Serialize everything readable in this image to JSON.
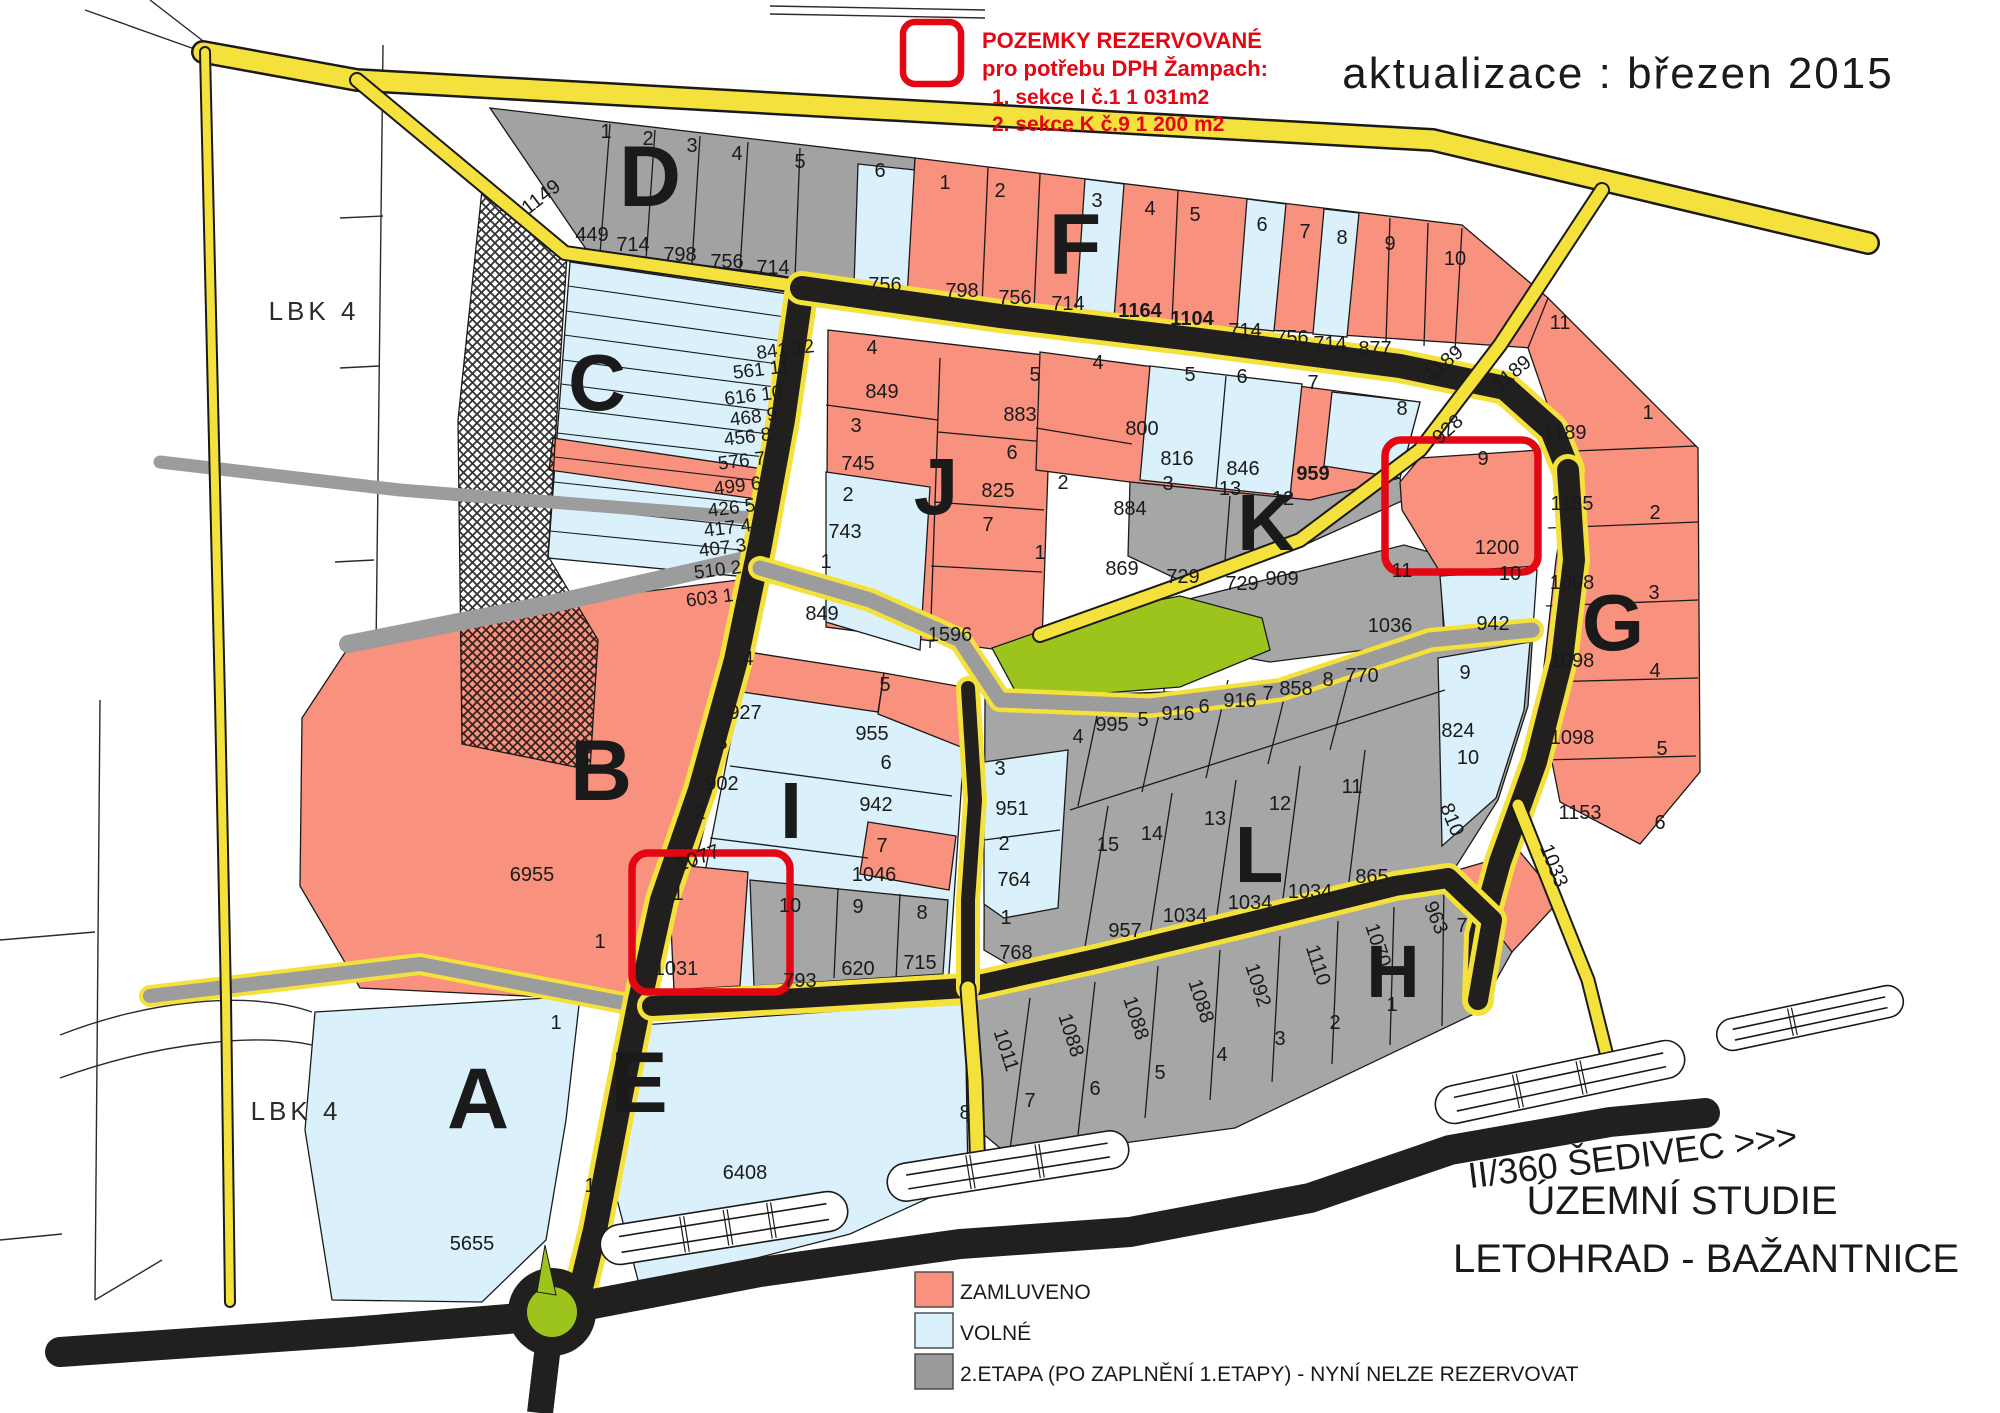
{
  "document": {
    "type": "zoning-plan-scan",
    "update_note": "aktualizace : březen 2015",
    "reserved_note": {
      "lines": [
        {
          "t": "POZEMKY REZERVOVANÉ",
          "x": 982,
          "y": 48
        },
        {
          "t": "pro potřebu DPH Žampach:",
          "x": 982,
          "y": 76
        },
        {
          "t": "1. sekce I  č.1   1 031m2",
          "x": 992,
          "y": 104
        },
        {
          "t": "2. sekce K č.9   1 200 m2",
          "x": 992,
          "y": 131
        }
      ],
      "color": "#e30613"
    },
    "titles": {
      "road": "II/360 ŠEDIVEC >>>",
      "study": "ÚZEMNÍ STUDIE",
      "place": "LETOHRAD - BAŽANTNICE"
    }
  },
  "legend": {
    "x": 915,
    "y0": 1272,
    "dy": 41,
    "items": [
      {
        "label": "ZAMLUVENO",
        "color": "#f9917f"
      },
      {
        "label": "VOLNÉ",
        "color": "#daf1fb"
      },
      {
        "label": "2.ETAPA (PO ZAPLNĚNÍ 1.ETAPY) - NYNÍ NELZE REZERVOVAT",
        "color": "#9a9a9a"
      }
    ]
  },
  "map_colors": {
    "reserved_outline": "#e30613",
    "booked_salmon": "#f9917f",
    "free_blue": "#daf1fb",
    "stage2_gray": "#a6a6a6",
    "road_yellow": "#f5e13b",
    "road_black": "#221f1f",
    "green": "#9dc41d"
  },
  "map": {
    "labels": [
      {
        "t": "POZEMKY REZERVOVANÉ",
        "x": 982,
        "y": 48,
        "s": 22,
        "w": 700,
        "c": "#e30613",
        "a": "start",
        "n": "reserved-note-line1"
      },
      {
        "t": "pro potřebu DPH Žampach:",
        "x": 982,
        "y": 76,
        "s": 22,
        "w": 700,
        "c": "#e30613",
        "a": "start",
        "n": "reserved-note-line2"
      },
      {
        "t": "1. sekce I  č.1   1 031m2",
        "x": 992,
        "y": 104,
        "s": 21,
        "w": 700,
        "c": "#e30613",
        "a": "start",
        "n": "reserved-note-line3"
      },
      {
        "t": "2. sekce K č.9   1 200 m2",
        "x": 992,
        "y": 131,
        "s": 21,
        "w": 700,
        "c": "#e30613",
        "a": "start",
        "n": "reserved-note-line4"
      },
      {
        "t": "aktualizace : březen 2015",
        "x": 1618,
        "y": 88,
        "s": 44,
        "ls": 2,
        "n": "update-note"
      },
      {
        "t": "II/360 ŠEDIVEC >>>",
        "x": 1634,
        "y": 1168,
        "s": 36,
        "f": "serif",
        "r": -7,
        "n": "road-title"
      },
      {
        "t": "ÚZEMNÍ STUDIE",
        "x": 1682,
        "y": 1214,
        "s": 40,
        "f": "serif",
        "n": "study-title"
      },
      {
        "t": "LETOHRAD - BAŽANTNICE",
        "x": 1706,
        "y": 1272,
        "s": 40,
        "f": "serif",
        "n": "place-title"
      },
      {
        "t": "LBK  4",
        "x": 314,
        "y": 320,
        "s": 26,
        "ls": 4,
        "c": "#2b2b2b",
        "n": "lbk-label-top"
      },
      {
        "t": "LBK  4",
        "x": 296,
        "y": 1120,
        "s": 26,
        "ls": 4,
        "c": "#2b2b2b",
        "n": "lbk-label-bottom"
      },
      {
        "t": "D",
        "x": 650,
        "y": 206,
        "s": 86,
        "w": 900,
        "n": "section-letter-d"
      },
      {
        "t": "F",
        "x": 1075,
        "y": 274,
        "s": 86,
        "w": 900,
        "n": "section-letter-f"
      },
      {
        "t": "C",
        "x": 597,
        "y": 410,
        "s": 80,
        "w": 900,
        "n": "section-letter-c"
      },
      {
        "t": "J",
        "x": 936,
        "y": 514,
        "s": 80,
        "w": 900,
        "n": "section-letter-j"
      },
      {
        "t": "K",
        "x": 1266,
        "y": 550,
        "s": 80,
        "w": 900,
        "n": "section-letter-k"
      },
      {
        "t": "G",
        "x": 1613,
        "y": 650,
        "s": 80,
        "w": 900,
        "n": "section-letter-g"
      },
      {
        "t": "B",
        "x": 601,
        "y": 800,
        "s": 86,
        "w": 900,
        "n": "section-letter-b"
      },
      {
        "t": "I",
        "x": 791,
        "y": 838,
        "s": 80,
        "w": 900,
        "n": "section-letter-i"
      },
      {
        "t": "L",
        "x": 1259,
        "y": 882,
        "s": 80,
        "w": 900,
        "n": "section-letter-l"
      },
      {
        "t": "H",
        "x": 1393,
        "y": 997,
        "s": 74,
        "w": 900,
        "n": "section-letter-h"
      },
      {
        "t": "A",
        "x": 478,
        "y": 1128,
        "s": 86,
        "w": 900,
        "n": "section-letter-a"
      },
      {
        "t": "E",
        "x": 639,
        "y": 1112,
        "s": 86,
        "w": 900,
        "n": "section-letter-e"
      },
      {
        "t": "1",
        "x": 606,
        "y": 138
      },
      {
        "t": "2",
        "x": 648,
        "y": 145
      },
      {
        "t": "3",
        "x": 692,
        "y": 152
      },
      {
        "t": "4",
        "x": 737,
        "y": 160
      },
      {
        "t": "5",
        "x": 800,
        "y": 168
      },
      {
        "t": "6",
        "x": 880,
        "y": 177
      },
      {
        "t": "1149",
        "x": 545,
        "y": 202,
        "r": -38
      },
      {
        "t": "449",
        "x": 592,
        "y": 241
      },
      {
        "t": "714",
        "x": 633,
        "y": 251
      },
      {
        "t": "798",
        "x": 680,
        "y": 261
      },
      {
        "t": "756",
        "x": 727,
        "y": 268
      },
      {
        "t": "714",
        "x": 773,
        "y": 274
      },
      {
        "t": "756",
        "x": 885,
        "y": 291
      },
      {
        "t": "1",
        "x": 945,
        "y": 189
      },
      {
        "t": "2",
        "x": 1000,
        "y": 197
      },
      {
        "t": "3",
        "x": 1097,
        "y": 207
      },
      {
        "t": "4",
        "x": 1150,
        "y": 215
      },
      {
        "t": "5",
        "x": 1195,
        "y": 221
      },
      {
        "t": "6",
        "x": 1262,
        "y": 231
      },
      {
        "t": "7",
        "x": 1305,
        "y": 238
      },
      {
        "t": "8",
        "x": 1342,
        "y": 244
      },
      {
        "t": "9",
        "x": 1390,
        "y": 250
      },
      {
        "t": "10",
        "x": 1455,
        "y": 265
      },
      {
        "t": "11",
        "x": 1560,
        "y": 329
      },
      {
        "t": "798",
        "x": 962,
        "y": 297
      },
      {
        "t": "756",
        "x": 1015,
        "y": 304
      },
      {
        "t": "714",
        "x": 1068,
        "y": 310
      },
      {
        "t": "1164",
        "x": 1140,
        "y": 317,
        "w": 700
      },
      {
        "t": "1104",
        "x": 1192,
        "y": 325,
        "w": 700
      },
      {
        "t": "714",
        "x": 1245,
        "y": 337
      },
      {
        "t": "756",
        "x": 1292,
        "y": 344
      },
      {
        "t": "714",
        "x": 1330,
        "y": 350
      },
      {
        "t": "877",
        "x": 1375,
        "y": 355
      },
      {
        "t": "1189",
        "x": 1448,
        "y": 368,
        "r": -40
      },
      {
        "t": "1189",
        "x": 1516,
        "y": 378,
        "r": -40
      },
      {
        "t": "928",
        "x": 1452,
        "y": 434,
        "r": -42
      },
      {
        "t": "841 12",
        "x": 815,
        "y": 352,
        "s": 19,
        "a": "end",
        "r": -7
      },
      {
        "t": "561 11",
        "x": 790,
        "y": 372,
        "s": 19,
        "a": "end",
        "r": -7
      },
      {
        "t": "616 10",
        "x": 783,
        "y": 398,
        "s": 19,
        "a": "end",
        "r": -7
      },
      {
        "t": "468  9",
        "x": 778,
        "y": 420,
        "s": 19,
        "a": "end",
        "r": -7
      },
      {
        "t": "456  8",
        "x": 772,
        "y": 440,
        "s": 19,
        "a": "end",
        "r": -7
      },
      {
        "t": "576  7",
        "x": 766,
        "y": 464,
        "s": 19,
        "a": "end",
        "r": -7
      },
      {
        "t": "499  6",
        "x": 762,
        "y": 489,
        "s": 19,
        "a": "end",
        "r": -7
      },
      {
        "t": "426  5",
        "x": 756,
        "y": 511,
        "s": 19,
        "a": "end",
        "r": -7
      },
      {
        "t": "417  4",
        "x": 752,
        "y": 531,
        "s": 19,
        "a": "end",
        "r": -7
      },
      {
        "t": "407  3",
        "x": 747,
        "y": 551,
        "s": 19,
        "a": "end",
        "r": -7
      },
      {
        "t": "510  2",
        "x": 742,
        "y": 573,
        "s": 19,
        "a": "end",
        "r": -7
      },
      {
        "t": "603  1",
        "x": 734,
        "y": 601,
        "s": 19,
        "a": "end",
        "r": -7
      },
      {
        "t": "4",
        "x": 872,
        "y": 354
      },
      {
        "t": "849",
        "x": 882,
        "y": 398
      },
      {
        "t": "3",
        "x": 856,
        "y": 432
      },
      {
        "t": "745",
        "x": 858,
        "y": 470
      },
      {
        "t": "2",
        "x": 848,
        "y": 501
      },
      {
        "t": "743",
        "x": 845,
        "y": 538
      },
      {
        "t": "1",
        "x": 826,
        "y": 568
      },
      {
        "t": "849",
        "x": 822,
        "y": 620
      },
      {
        "t": "5",
        "x": 1035,
        "y": 381
      },
      {
        "t": "883",
        "x": 1020,
        "y": 421
      },
      {
        "t": "6",
        "x": 1012,
        "y": 459
      },
      {
        "t": "825",
        "x": 998,
        "y": 497
      },
      {
        "t": "7",
        "x": 988,
        "y": 531
      },
      {
        "t": "1596",
        "x": 950,
        "y": 641
      },
      {
        "t": "4",
        "x": 1098,
        "y": 369
      },
      {
        "t": "800",
        "x": 1142,
        "y": 435
      },
      {
        "t": "5",
        "x": 1190,
        "y": 381
      },
      {
        "t": "816",
        "x": 1177,
        "y": 465
      },
      {
        "t": "6",
        "x": 1242,
        "y": 383
      },
      {
        "t": "846",
        "x": 1243,
        "y": 475
      },
      {
        "t": "7",
        "x": 1313,
        "y": 389
      },
      {
        "t": "959",
        "x": 1313,
        "y": 480,
        "w": 700
      },
      {
        "t": "8",
        "x": 1402,
        "y": 415
      },
      {
        "t": "2",
        "x": 1063,
        "y": 489
      },
      {
        "t": "884",
        "x": 1130,
        "y": 515
      },
      {
        "t": "3",
        "x": 1168,
        "y": 490
      },
      {
        "t": "13",
        "x": 1230,
        "y": 495
      },
      {
        "t": "12",
        "x": 1283,
        "y": 505
      },
      {
        "t": "1",
        "x": 1040,
        "y": 559
      },
      {
        "t": "869",
        "x": 1122,
        "y": 575
      },
      {
        "t": "729",
        "x": 1183,
        "y": 583
      },
      {
        "t": "729",
        "x": 1242,
        "y": 590
      },
      {
        "t": "909",
        "x": 1282,
        "y": 585
      },
      {
        "t": "9",
        "x": 1483,
        "y": 465
      },
      {
        "t": "1200",
        "x": 1497,
        "y": 554
      },
      {
        "t": "11",
        "x": 1402,
        "y": 577
      },
      {
        "t": "10",
        "x": 1510,
        "y": 580
      },
      {
        "t": "1036",
        "x": 1390,
        "y": 632
      },
      {
        "t": "942",
        "x": 1493,
        "y": 630
      },
      {
        "t": "1",
        "x": 1648,
        "y": 419
      },
      {
        "t": "1189",
        "x": 1565,
        "y": 439
      },
      {
        "t": "2",
        "x": 1655,
        "y": 519
      },
      {
        "t": "1135",
        "x": 1572,
        "y": 510
      },
      {
        "t": "3",
        "x": 1654,
        "y": 599
      },
      {
        "t": "1098",
        "x": 1572,
        "y": 589
      },
      {
        "t": "4",
        "x": 1655,
        "y": 677
      },
      {
        "t": "1098",
        "x": 1572,
        "y": 667
      },
      {
        "t": "5",
        "x": 1662,
        "y": 755
      },
      {
        "t": "1098",
        "x": 1572,
        "y": 744
      },
      {
        "t": "6",
        "x": 1660,
        "y": 829
      },
      {
        "t": "1153",
        "x": 1580,
        "y": 819
      },
      {
        "t": "1033",
        "x": 1548,
        "y": 868,
        "r": 68
      },
      {
        "t": "7",
        "x": 1462,
        "y": 932
      },
      {
        "t": "6955",
        "x": 532,
        "y": 881
      },
      {
        "t": "1",
        "x": 600,
        "y": 948
      },
      {
        "t": "4",
        "x": 748,
        "y": 665
      },
      {
        "t": "927",
        "x": 745,
        "y": 719
      },
      {
        "t": "3",
        "x": 722,
        "y": 749
      },
      {
        "t": "902",
        "x": 722,
        "y": 790
      },
      {
        "t": "2",
        "x": 700,
        "y": 819
      },
      {
        "t": "1077",
        "x": 700,
        "y": 864,
        "r": -20
      },
      {
        "t": "1",
        "x": 678,
        "y": 900
      },
      {
        "t": "1031",
        "x": 676,
        "y": 975
      },
      {
        "t": "5",
        "x": 885,
        "y": 691
      },
      {
        "t": "955",
        "x": 872,
        "y": 740
      },
      {
        "t": "6",
        "x": 886,
        "y": 769
      },
      {
        "t": "942",
        "x": 876,
        "y": 811
      },
      {
        "t": "7",
        "x": 882,
        "y": 852
      },
      {
        "t": "1046",
        "x": 874,
        "y": 881
      },
      {
        "t": "10",
        "x": 790,
        "y": 912
      },
      {
        "t": "9",
        "x": 858,
        "y": 913
      },
      {
        "t": "8",
        "x": 922,
        "y": 919
      },
      {
        "t": "793",
        "x": 800,
        "y": 987
      },
      {
        "t": "620",
        "x": 858,
        "y": 975
      },
      {
        "t": "715",
        "x": 920,
        "y": 969
      },
      {
        "t": "3",
        "x": 1000,
        "y": 775
      },
      {
        "t": "951",
        "x": 1012,
        "y": 815
      },
      {
        "t": "2",
        "x": 1004,
        "y": 850
      },
      {
        "t": "764",
        "x": 1014,
        "y": 886
      },
      {
        "t": "1",
        "x": 1006,
        "y": 924
      },
      {
        "t": "768",
        "x": 1016,
        "y": 959
      },
      {
        "t": "4",
        "x": 1078,
        "y": 743
      },
      {
        "t": "995",
        "x": 1112,
        "y": 731
      },
      {
        "t": "5",
        "x": 1143,
        "y": 726
      },
      {
        "t": "916",
        "x": 1178,
        "y": 720
      },
      {
        "t": "6",
        "x": 1204,
        "y": 713
      },
      {
        "t": "916",
        "x": 1240,
        "y": 707
      },
      {
        "t": "7",
        "x": 1268,
        "y": 700
      },
      {
        "t": "858",
        "x": 1296,
        "y": 695
      },
      {
        "t": "8",
        "x": 1328,
        "y": 686
      },
      {
        "t": "770",
        "x": 1362,
        "y": 682
      },
      {
        "t": "9",
        "x": 1465,
        "y": 679
      },
      {
        "t": "824",
        "x": 1458,
        "y": 737
      },
      {
        "t": "10",
        "x": 1468,
        "y": 764
      },
      {
        "t": "810",
        "x": 1446,
        "y": 822,
        "r": 68
      },
      {
        "t": "11",
        "x": 1352,
        "y": 793
      },
      {
        "t": "12",
        "x": 1280,
        "y": 810
      },
      {
        "t": "13",
        "x": 1215,
        "y": 825
      },
      {
        "t": "14",
        "x": 1152,
        "y": 840
      },
      {
        "t": "15",
        "x": 1108,
        "y": 851
      },
      {
        "t": "957",
        "x": 1125,
        "y": 937
      },
      {
        "t": "1034",
        "x": 1185,
        "y": 922
      },
      {
        "t": "1034",
        "x": 1250,
        "y": 909
      },
      {
        "t": "1034",
        "x": 1310,
        "y": 898
      },
      {
        "t": "865",
        "x": 1372,
        "y": 883
      },
      {
        "t": "1011",
        "x": 1000,
        "y": 1052,
        "r": 72
      },
      {
        "t": "1088",
        "x": 1065,
        "y": 1037,
        "r": 72
      },
      {
        "t": "1088",
        "x": 1130,
        "y": 1020,
        "r": 72
      },
      {
        "t": "1088",
        "x": 1195,
        "y": 1003,
        "r": 72
      },
      {
        "t": "1092",
        "x": 1252,
        "y": 987,
        "r": 72
      },
      {
        "t": "1110",
        "x": 1312,
        "y": 967,
        "r": 72
      },
      {
        "t": "1070",
        "x": 1372,
        "y": 947,
        "r": 72
      },
      {
        "t": "963",
        "x": 1430,
        "y": 920,
        "r": 68
      },
      {
        "t": "8",
        "x": 965,
        "y": 1119
      },
      {
        "t": "7",
        "x": 1030,
        "y": 1107
      },
      {
        "t": "6",
        "x": 1095,
        "y": 1095
      },
      {
        "t": "5",
        "x": 1160,
        "y": 1079
      },
      {
        "t": "4",
        "x": 1222,
        "y": 1061
      },
      {
        "t": "3",
        "x": 1280,
        "y": 1045
      },
      {
        "t": "2",
        "x": 1335,
        "y": 1029
      },
      {
        "t": "1",
        "x": 1392,
        "y": 1011
      },
      {
        "t": "5655",
        "x": 472,
        "y": 1250
      },
      {
        "t": "1",
        "x": 556,
        "y": 1029
      },
      {
        "t": "6408",
        "x": 745,
        "y": 1179
      },
      {
        "t": "1",
        "x": 590,
        "y": 1192
      }
    ]
  }
}
